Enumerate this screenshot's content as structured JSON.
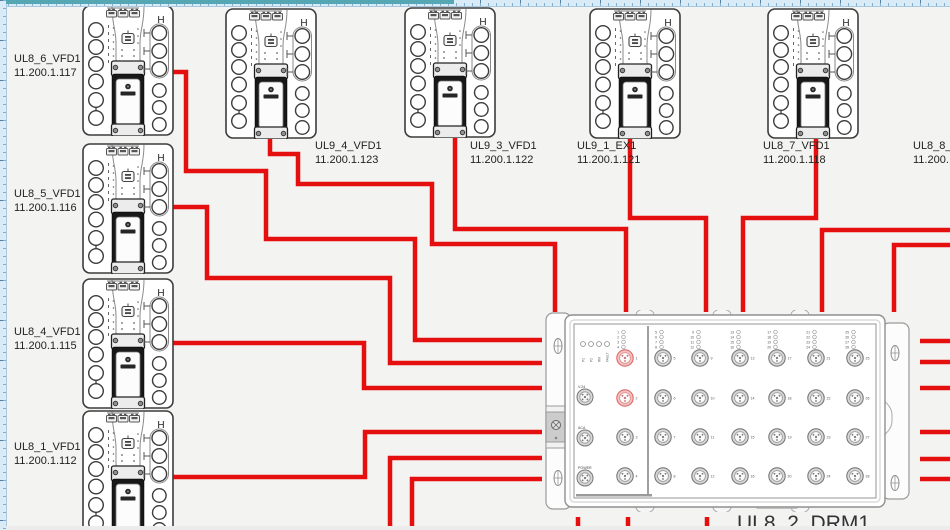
{
  "canvas": {
    "background": "#f3f3f2",
    "ruler_color": "#d9ebf7",
    "cable_color": "#e50f0f",
    "highlight_port_color": "#e06666"
  },
  "vfd": {
    "corner_label": "H"
  },
  "devices": [
    {
      "id": "UL8_6_VFD1",
      "ip": "11.200.1.117",
      "x": 82,
      "y": 5,
      "label": {
        "x": 14,
        "y": 53
      }
    },
    {
      "id": "UL8_5_VFD1",
      "ip": "11.200.1.116",
      "x": 82,
      "y": 143,
      "label": {
        "x": 14,
        "y": 188
      }
    },
    {
      "id": "UL8_4_VFD1",
      "ip": "11.200.1.115",
      "x": 82,
      "y": 278,
      "label": {
        "x": 14,
        "y": 326
      }
    },
    {
      "id": "UL8_1_VFD1",
      "ip": "11.200.1.112",
      "x": 82,
      "y": 410,
      "label": {
        "x": 14,
        "y": 441
      }
    },
    {
      "id": "UL9_4_VFD1",
      "ip": "11.200.1.123",
      "x": 225,
      "y": 8,
      "label": {
        "x": 315,
        "y": 140
      }
    },
    {
      "id": "UL9_3_VFD1",
      "ip": "11.200.1.122",
      "x": 404,
      "y": 7,
      "label": {
        "x": 470,
        "y": 140
      }
    },
    {
      "id": "UL9_1_EX1",
      "ip": "11.200.1.121",
      "x": 589,
      "y": 8,
      "label": {
        "x": 577,
        "y": 140
      }
    },
    {
      "id": "UL8_7_VFD1",
      "ip": "11.200.1.118",
      "x": 767,
      "y": 8,
      "label": {
        "x": 763,
        "y": 140
      }
    }
  ],
  "offscreen_label": {
    "id": "UL8_8_V",
    "ip": "11.200.",
    "x": 913,
    "y": 140
  },
  "drm": {
    "label": "UL8_2_DRM1",
    "x": 545,
    "y": 310,
    "status_leds": [
      "P1",
      "P2",
      "RM",
      "FAULT"
    ],
    "aux_ports": [
      "V.24",
      "ACA",
      "POWER"
    ],
    "led_groups": [
      [
        1,
        2,
        3,
        4
      ],
      [
        5,
        6,
        7,
        8
      ],
      [
        9,
        10,
        11,
        12
      ],
      [
        13,
        14,
        15,
        16
      ],
      [
        17,
        18,
        19,
        20
      ],
      [
        21,
        22,
        23,
        24
      ],
      [
        25,
        26,
        27,
        28
      ]
    ],
    "highlighted_ports": [
      1,
      2
    ]
  },
  "cables": [
    {
      "name": "ul8_6-to-drm",
      "points": [
        [
          172,
          72
        ],
        [
          186,
          72
        ],
        [
          186,
          171
        ],
        [
          266,
          171
        ],
        [
          266,
          239
        ],
        [
          415,
          239
        ],
        [
          415,
          340
        ],
        [
          542,
          340
        ]
      ]
    },
    {
      "name": "ul8_5-to-drm",
      "points": [
        [
          172,
          207
        ],
        [
          207,
          207
        ],
        [
          207,
          278
        ],
        [
          390,
          278
        ],
        [
          390,
          363
        ],
        [
          542,
          363
        ]
      ]
    },
    {
      "name": "ul8_4-to-drm",
      "points": [
        [
          172,
          343
        ],
        [
          364,
          343
        ],
        [
          364,
          388
        ],
        [
          542,
          388
        ]
      ]
    },
    {
      "name": "ul8_1-to-drm",
      "points": [
        [
          172,
          477
        ],
        [
          365,
          477
        ],
        [
          365,
          432
        ],
        [
          542,
          432
        ]
      ]
    },
    {
      "name": "ul9_4-to-drm",
      "points": [
        [
          270,
          134
        ],
        [
          270,
          154
        ],
        [
          298,
          154
        ],
        [
          298,
          184
        ],
        [
          432,
          184
        ],
        [
          432,
          244
        ],
        [
          555,
          244
        ],
        [
          555,
          312
        ]
      ]
    },
    {
      "name": "ul9_3-to-drm",
      "points": [
        [
          455,
          135
        ],
        [
          455,
          229
        ],
        [
          626,
          229
        ],
        [
          626,
          312
        ]
      ]
    },
    {
      "name": "ul9_1-to-drm",
      "points": [
        [
          630,
          138
        ],
        [
          630,
          218
        ],
        [
          706,
          218
        ],
        [
          706,
          312
        ]
      ]
    },
    {
      "name": "ul8_7-to-drm",
      "points": [
        [
          816,
          138
        ],
        [
          816,
          218
        ],
        [
          743,
          218
        ],
        [
          743,
          312
        ]
      ]
    },
    {
      "name": "right-edge-1-to-drm",
      "points": [
        [
          950,
          230
        ],
        [
          822,
          230
        ],
        [
          822,
          312
        ]
      ]
    },
    {
      "name": "right-edge-2-to-drm",
      "points": [
        [
          950,
          245
        ],
        [
          894,
          245
        ],
        [
          894,
          312
        ]
      ]
    },
    {
      "name": "drm-right-stub-1",
      "points": [
        [
          920,
          341
        ],
        [
          950,
          341
        ]
      ]
    },
    {
      "name": "drm-right-stub-2",
      "points": [
        [
          920,
          362
        ],
        [
          950,
          362
        ]
      ]
    },
    {
      "name": "drm-right-stub-3",
      "points": [
        [
          920,
          388
        ],
        [
          950,
          388
        ]
      ]
    },
    {
      "name": "drm-right-stub-4",
      "points": [
        [
          920,
          432
        ],
        [
          950,
          432
        ]
      ]
    },
    {
      "name": "drm-right-stub-5",
      "points": [
        [
          920,
          459
        ],
        [
          950,
          459
        ]
      ]
    },
    {
      "name": "drm-right-stub-6",
      "points": [
        [
          920,
          479
        ],
        [
          950,
          479
        ]
      ]
    },
    {
      "name": "drm-left-down-1",
      "points": [
        [
          542,
          458
        ],
        [
          390,
          458
        ],
        [
          390,
          531
        ]
      ]
    },
    {
      "name": "drm-left-down-2",
      "points": [
        [
          542,
          479
        ],
        [
          412,
          479
        ],
        [
          412,
          531
        ]
      ]
    },
    {
      "name": "drm-bottom-stub-1",
      "points": [
        [
          578,
          517
        ],
        [
          578,
          531
        ]
      ]
    },
    {
      "name": "drm-bottom-stub-2",
      "points": [
        [
          628,
          517
        ],
        [
          628,
          531
        ]
      ]
    },
    {
      "name": "drm-bottom-stub-3",
      "points": [
        [
          707,
          517
        ],
        [
          707,
          531
        ]
      ]
    }
  ]
}
